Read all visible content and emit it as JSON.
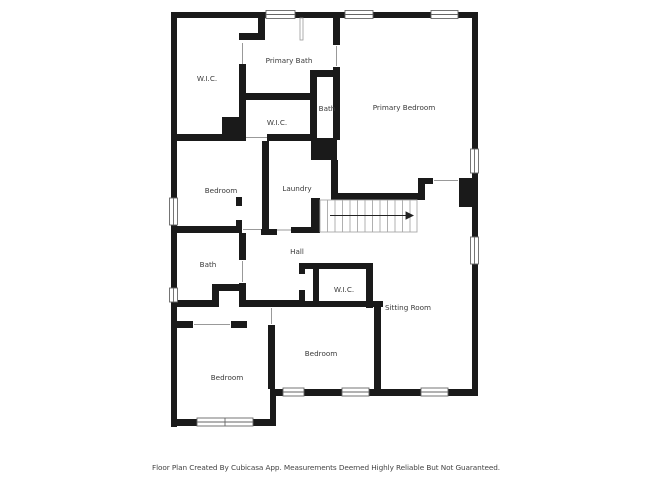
{
  "plan": {
    "source_note": "Floor Plan Created By Cubicasa App. Measurements Deemed Highly Reliable But Not Guaranteed."
  },
  "rooms": [
    {
      "label": "W.I.C."
    },
    {
      "label": "Primary Bath"
    },
    {
      "label": "Bath"
    },
    {
      "label": "W.I.C."
    },
    {
      "label": "Primary Bedroom"
    },
    {
      "label": "Bedroom"
    },
    {
      "label": "Laundry"
    },
    {
      "label": "Hall"
    },
    {
      "label": "Bath"
    },
    {
      "label": "W.I.C."
    },
    {
      "label": "Sitting Room"
    },
    {
      "label": "Bedroom"
    },
    {
      "label": "Bedroom"
    }
  ],
  "stairs": {
    "treads": 13,
    "direction_arrow": "right"
  },
  "colors": {
    "wall": "#1a1a1a",
    "floor": "#ffffff",
    "label": "#3a3a3a",
    "window_frame": "#666666",
    "door_line": "#999999",
    "stair_outline": "#a8a8a8",
    "stair_arrow": "#222222",
    "footer_text": "#444444"
  }
}
